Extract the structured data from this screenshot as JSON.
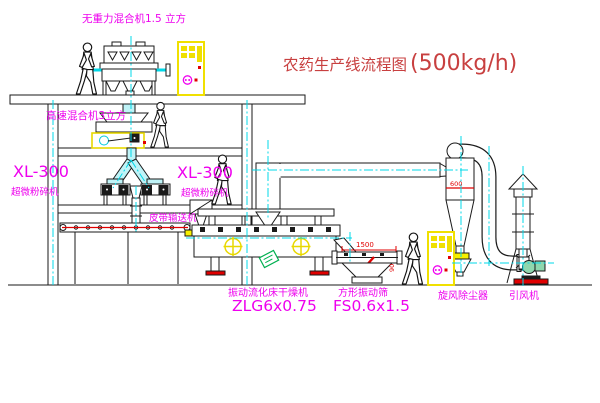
{
  "title": {
    "text": "农药生产线流程图",
    "capacity": "(500kg/h)"
  },
  "annotations": {
    "gravityless_mixer": "无重力混合机1.5 立方",
    "high_speed_mixer": "高速混合机3立方",
    "pulverizer_left_model": "XL-300",
    "pulverizer_left_name": "超微粉碎机",
    "pulverizer_mid_model": "XL-300",
    "pulverizer_mid_name": "超微粉碎机",
    "belt_conveyor": "皮带输送机",
    "dryer_name": "振动流化床干燥机",
    "dryer_model": "ZLG6x0.75",
    "sieve_name": "方形振动筛",
    "sieve_model": "FS0.6x1.5",
    "cyclone_name": "旋风除尘器",
    "fan_name": "引风机"
  },
  "dimensions": {
    "sieve_length": "1500",
    "cyclone": "600",
    "sieve_drop": "90"
  },
  "colors": {
    "label_magenta": "#ee00ee",
    "title_red": "#c84040",
    "centerline_cyan": "#00d8e8",
    "panel_yellow": "#f0e000",
    "accent_red": "#e00000",
    "nameplate_green": "#00b050",
    "line_black": "#1a1a1a"
  }
}
